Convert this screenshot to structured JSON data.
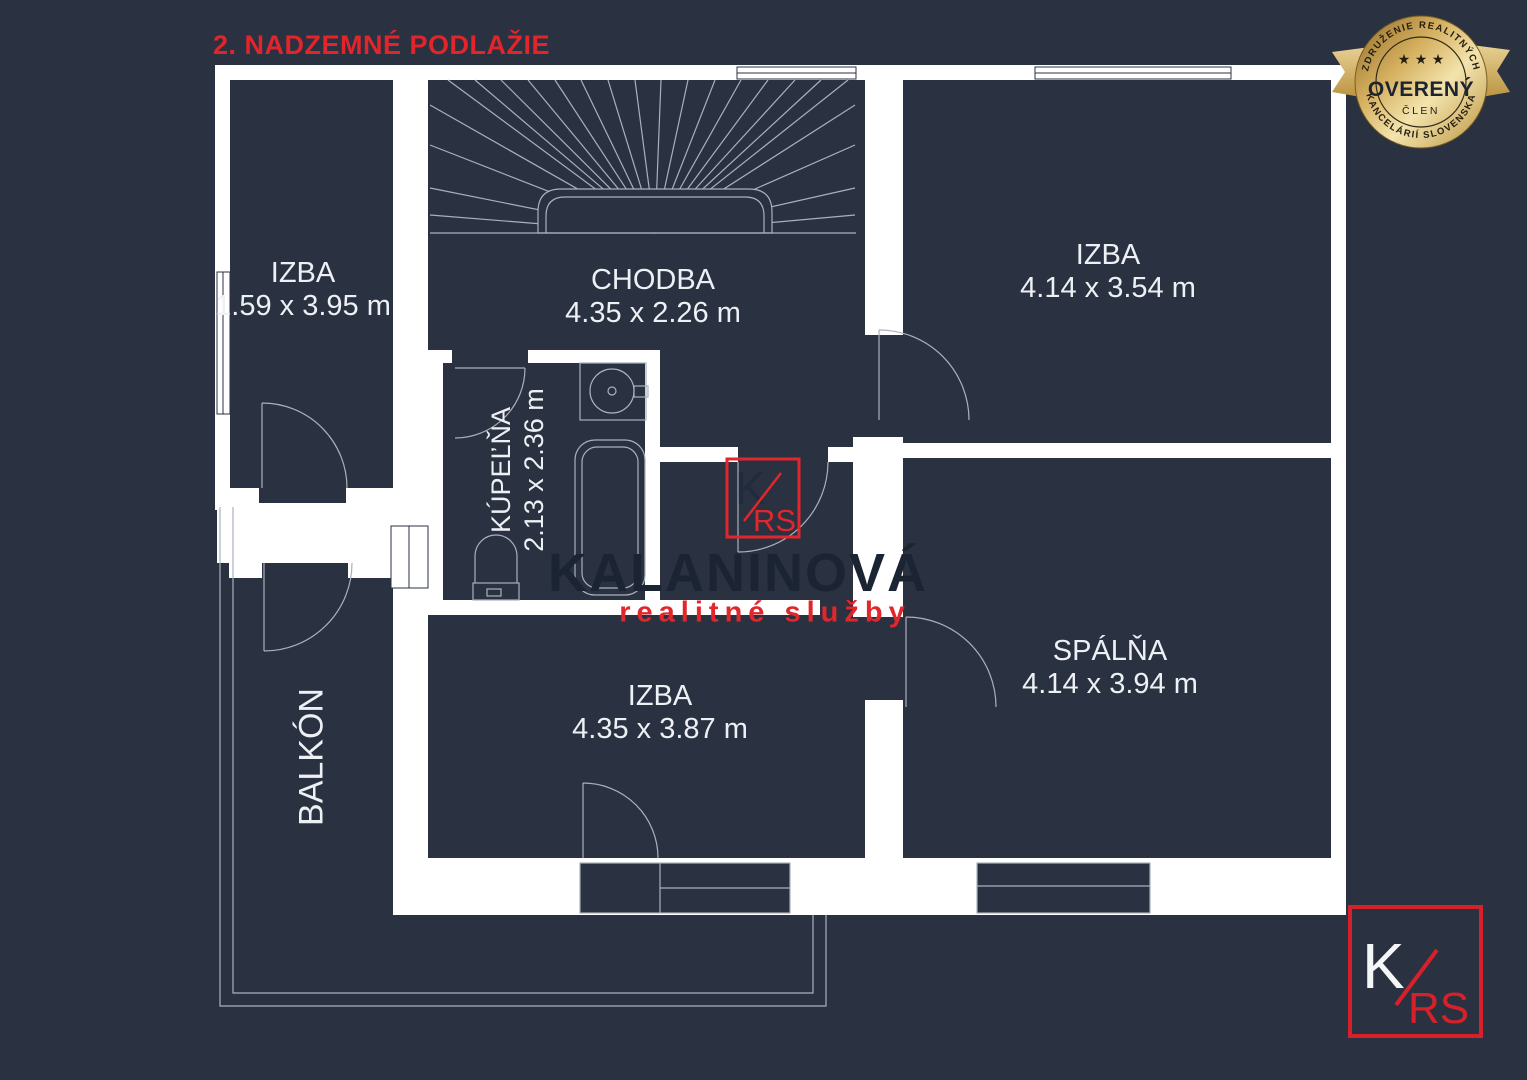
{
  "title": "2. NADZEMNÉ PODLAŽIE",
  "badge": {
    "arc_top": "ZDRUŽENIE REALITNÝCH",
    "arc_bottom": "KANCELÁRIÍ SLOVENSKA",
    "stars": "★ ★ ★",
    "center": "OVERENÝ",
    "sub": "ČLEN"
  },
  "watermark": {
    "name": "KALANINOVÁ",
    "tagline": "realitné služby",
    "logo_k": "K",
    "logo_rs": "RS"
  },
  "rooms": [
    {
      "id": "izba-left",
      "name": "IZBA",
      "dims": "1.59 x 3.95 m"
    },
    {
      "id": "chodba",
      "name": "CHODBA",
      "dims": "4.35 x 2.26 m"
    },
    {
      "id": "izba-top-right",
      "name": "IZBA",
      "dims": "4.14 x 3.54 m"
    },
    {
      "id": "kupelna",
      "name": "KÚPEĽŇA",
      "dims": "2.13 x 2.36 m"
    },
    {
      "id": "izba-bottom",
      "name": "IZBA",
      "dims": "4.35 x 3.87 m"
    },
    {
      "id": "spalna",
      "name": "SPÁLŇA",
      "dims": "4.14 x 3.94 m"
    },
    {
      "id": "balkon",
      "name": "BALKÓN",
      "dims": ""
    }
  ],
  "colors": {
    "background_navy": "#2a3140",
    "wall_white": "#ffffff",
    "thin_line": "#a9b1bf",
    "accent_red": "#e1262c",
    "watermark_navy": "#1b2433",
    "badge_gold": "#d4af5e",
    "badge_text": "#241e10"
  }
}
